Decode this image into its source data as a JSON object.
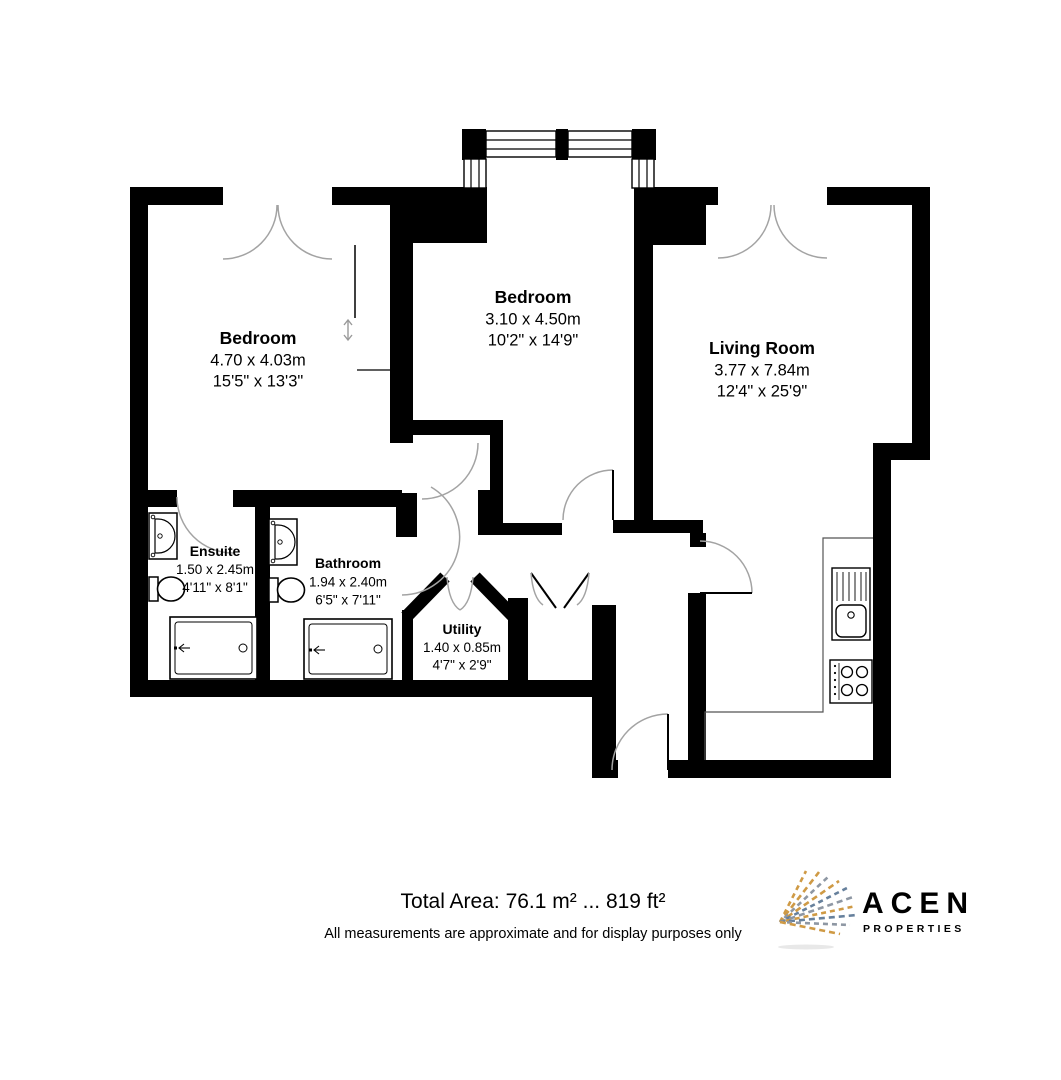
{
  "floorplan": {
    "rooms": [
      {
        "name": "Bedroom",
        "metric": "4.70 x 4.03m",
        "imperial": "15'5\" x 13'3\""
      },
      {
        "name": "Bedroom",
        "metric": "3.10 x 4.50m",
        "imperial": "10'2\" x 14'9\""
      },
      {
        "name": "Living Room",
        "metric": "3.77 x 7.84m",
        "imperial": "12'4\" x 25'9\""
      },
      {
        "name": "Ensuite",
        "metric": "1.50 x 2.45m",
        "imperial": "4'11\" x 8'1\""
      },
      {
        "name": "Bathroom",
        "metric": "1.94 x 2.40m",
        "imperial": "6'5\" x 7'11\""
      },
      {
        "name": "Utility",
        "metric": "1.40 x 0.85m",
        "imperial": "4'7\" x 2'9\""
      }
    ],
    "icons": [
      "bay-window",
      "double-swing-doors",
      "sliding-wardrobe-arrow",
      "kitchen-sink-drainer",
      "hob-4-ring",
      "wash-basin",
      "toilet",
      "shower-tray",
      "bifold-doors",
      "entrance-door"
    ]
  },
  "footer": {
    "total_area": "Total Area: 76.1 m² ... 819 ft²",
    "disclaimer": "All measurements are approximate and for display purposes only"
  },
  "logo": {
    "name": "ACEN",
    "sub": "PROPERTIES"
  },
  "colors": {
    "wall": "#000000",
    "door_arc": "#a3a3a3",
    "logo_text": "#333b4d",
    "logo_gold": "#cf9a45",
    "logo_gray": "#8e97a3",
    "logo_blue": "#66809c",
    "background": "#ffffff"
  }
}
